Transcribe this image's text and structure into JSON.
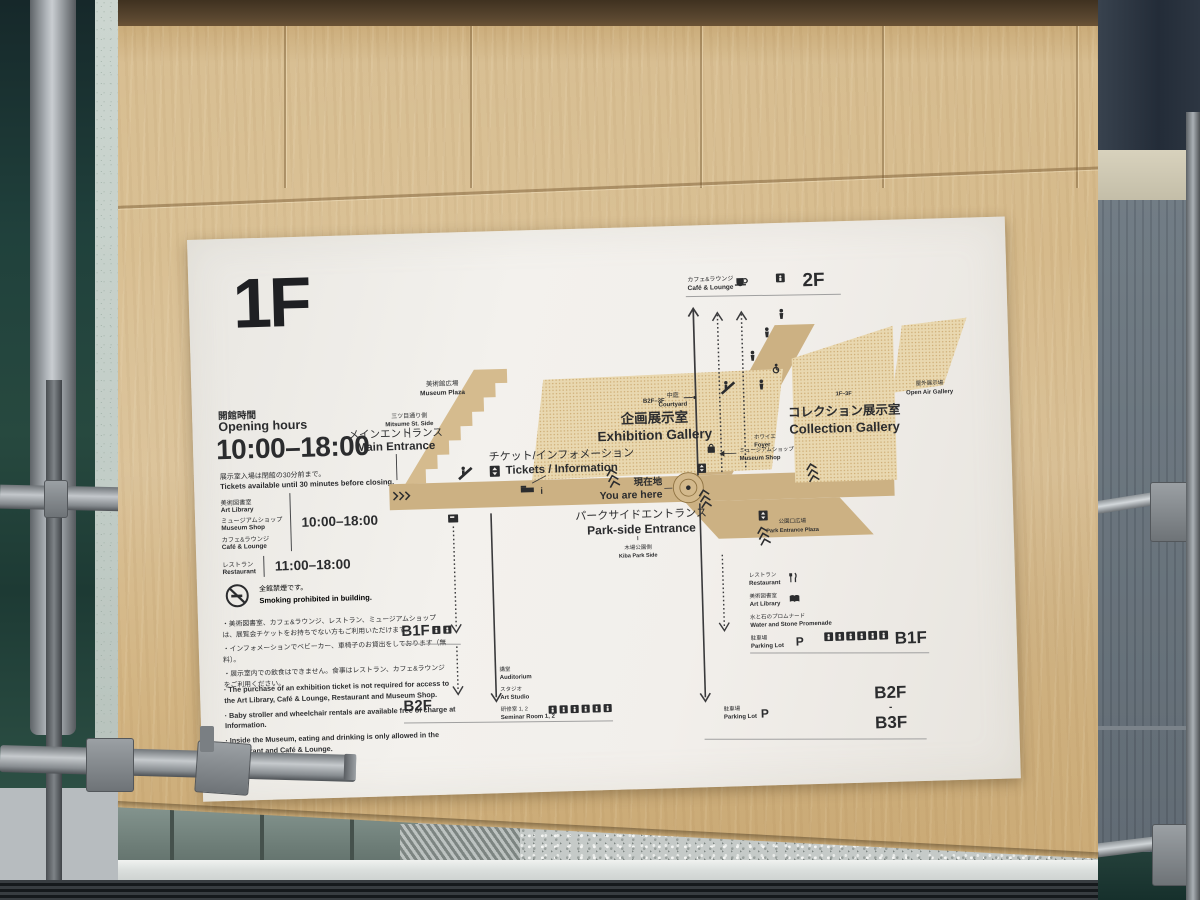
{
  "sign": {
    "floor": "1F",
    "opening": {
      "jp": "開館時間",
      "en": "Opening hours",
      "main_hours": "10:00–18:00",
      "note_jp": "展示室入場は閉館の30分前まで。",
      "note_en": "Tickets available until 30 minutes before closing.",
      "facility_hours": [
        {
          "labels": [
            {
              "jp": "美術図書室",
              "en": "Art Library"
            },
            {
              "jp": "ミュージアムショップ",
              "en": "Museum Shop"
            },
            {
              "jp": "カフェ&ラウンジ",
              "en": "Café & Lounge"
            }
          ],
          "time": "10:00–18:00"
        },
        {
          "labels": [
            {
              "jp": "レストラン",
              "en": "Restaurant"
            }
          ],
          "time": "11:00–18:00"
        }
      ]
    },
    "smoking": {
      "jp": "全館禁煙です。",
      "en": "Smoking prohibited in building."
    },
    "notes_jp": [
      "・美術図書室、カフェ&ラウンジ、レストラン、ミュージアムショップは、展覧会チケットをお持ちでない方もご利用いただけます。",
      "・インフォメーションでベビーカー、車椅子のお貸出をしております（無料）。",
      "・展示室内での飲食はできません。食事はレストラン、カフェ&ラウンジをご利用ください。"
    ],
    "notes_en": [
      "· The purchase of an exhibition ticket is not required for access to the Art Library, Café & Lounge, Restaurant and Museum Shop.",
      "· Baby stroller and wheelchair rentals are available free of charge at Information.",
      "· Inside the Museum, eating and drinking is only allowed in the Restaurant and Café & Lounge."
    ],
    "map": {
      "cafe_lounge": {
        "jp": "カフェ&ラウンジ",
        "en": "Café & Lounge"
      },
      "floor_2f": "2F",
      "museum_plaza": {
        "jp": "美術館広場",
        "en": "Museum Plaza"
      },
      "mitsume": {
        "jp": "三ツ目通り側",
        "en": "Mitsume St. Side"
      },
      "main_entrance": {
        "jp": "メインエントランス",
        "en": "Main Entrance"
      },
      "tickets_info": {
        "jp": "チケット/インフォメーション",
        "en": "Tickets / Information"
      },
      "exhibition_gallery": {
        "floors": "B2F–3F",
        "jp": "企画展示室",
        "en": "Exhibition Gallery"
      },
      "courtyard": {
        "jp": "中庭",
        "en": "Courtyard"
      },
      "foyer": {
        "jp": "ホワイエ",
        "en": "Foyer"
      },
      "museum_shop": {
        "jp": "ミュージアムショップ",
        "en": "Museum Shop"
      },
      "you_are_here": {
        "jp": "現在地",
        "en": "You are here"
      },
      "parkside_entrance": {
        "jp": "パークサイドエントランス",
        "en": "Park-side Entrance"
      },
      "kiba_park": {
        "jp": "木場公園側",
        "en": "Kiba Park Side"
      },
      "collection_gallery": {
        "floors": "1F–3F",
        "jp": "コレクション展示室",
        "en": "Collection Gallery"
      },
      "open_air_gallery": {
        "jp": "屋外展示場",
        "en": "Open Air Gallery"
      },
      "park_entrance_plaza": {
        "jp": "公園口広場",
        "en": "Park Entrance Plaza"
      },
      "restaurant": {
        "jp": "レストラン",
        "en": "Restaurant"
      },
      "art_library": {
        "jp": "美術図書室",
        "en": "Art Library"
      },
      "promenade": {
        "jp": "水と石のプロムナード",
        "en": "Water and Stone Promenade"
      },
      "parking_b1": {
        "jp": "駐車場",
        "en": "Parking Lot",
        "p": "P",
        "floor": "B1F"
      },
      "parking_lower": {
        "jp": "駐車場",
        "en": "Parking Lot",
        "p": "P",
        "from": "B2F",
        "dash": "-",
        "to": "B3F"
      },
      "b1f_left": "B1F",
      "b2f_left": "B2F",
      "auditorium": {
        "jp": "講堂",
        "en": "Auditorium"
      },
      "art_studio": {
        "jp": "スタジオ",
        "en": "Art Studio"
      },
      "seminar": {
        "jp": "研修室 1, 2",
        "en": "Seminar Room 1, 2"
      },
      "info_glyph": "i"
    }
  },
  "colors": {
    "accent_red": "#c5343a",
    "map_tan": "#ccb183",
    "map_dots_bg": "#e9d8b0",
    "map_dots": "#cdab72",
    "wood": "#d6ba8c",
    "ink": "#2b2c2e"
  }
}
